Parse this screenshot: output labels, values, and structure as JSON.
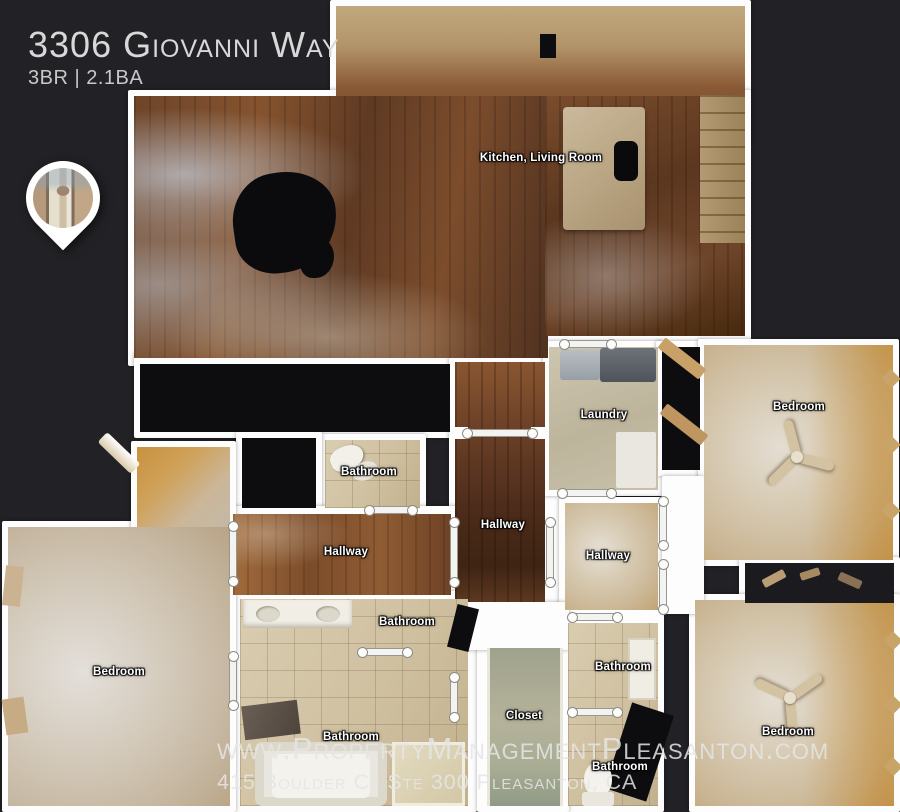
{
  "header": {
    "title": "3306 Giovanni Way",
    "subtitle": "3BR | 2.1BA"
  },
  "watermark": {
    "line1": "www.PropertyManagementPleasanton.com",
    "line2": "415 Boulder Ct Ste 300 Pleasanton, CA"
  },
  "colors": {
    "background": "#222226",
    "wall": "#fdfdfd",
    "label_text": "#ffffff",
    "title_text": "#d8d8d8",
    "watermark_text": "#e5e5e5",
    "wood_floor": "#6e452a",
    "carpet": "#d6c9b1",
    "tile": "#cfc0a0"
  },
  "floorplan": {
    "labels": [
      {
        "name": "label-kitchen-living-room",
        "text": "Kitchen, Living Room",
        "x": 541,
        "y": 158
      },
      {
        "name": "label-laundry",
        "text": "Laundry",
        "x": 604,
        "y": 415
      },
      {
        "name": "label-bedroom-top-right",
        "text": "Bedroom",
        "x": 799,
        "y": 407
      },
      {
        "name": "label-bathroom-top",
        "text": "Bathroom",
        "x": 369,
        "y": 472
      },
      {
        "name": "label-hallway-center",
        "text": "Hallway",
        "x": 503,
        "y": 525
      },
      {
        "name": "label-hallway-left",
        "text": "Hallway",
        "x": 346,
        "y": 552
      },
      {
        "name": "label-hallway-right",
        "text": "Hallway",
        "x": 608,
        "y": 556
      },
      {
        "name": "label-bathroom-toilet-room",
        "text": "Bathroom",
        "x": 407,
        "y": 622
      },
      {
        "name": "label-bathroom-right-upper",
        "text": "Bathroom",
        "x": 623,
        "y": 667
      },
      {
        "name": "label-bedroom-left",
        "text": "Bedroom",
        "x": 119,
        "y": 672
      },
      {
        "name": "label-closet",
        "text": "Closet",
        "x": 524,
        "y": 716
      },
      {
        "name": "label-bathroom-master",
        "text": "Bathroom",
        "x": 351,
        "y": 737
      },
      {
        "name": "label-bedroom-bottom-right",
        "text": "Bedroom",
        "x": 788,
        "y": 732
      },
      {
        "name": "label-bathroom-right-lower",
        "text": "Bathroom",
        "x": 620,
        "y": 767
      }
    ],
    "door_markers": [
      {
        "x": 467,
        "y": 429,
        "w": 66,
        "h": 8
      },
      {
        "x": 546,
        "y": 522,
        "w": 8,
        "h": 61
      },
      {
        "x": 450,
        "y": 522,
        "w": 8,
        "h": 61
      },
      {
        "x": 369,
        "y": 506,
        "w": 44,
        "h": 8
      },
      {
        "x": 229,
        "y": 526,
        "w": 8,
        "h": 56
      },
      {
        "x": 229,
        "y": 656,
        "w": 8,
        "h": 50
      },
      {
        "x": 562,
        "y": 489,
        "w": 50,
        "h": 8
      },
      {
        "x": 659,
        "y": 501,
        "w": 8,
        "h": 45
      },
      {
        "x": 659,
        "y": 564,
        "w": 8,
        "h": 46
      },
      {
        "x": 572,
        "y": 613,
        "w": 46,
        "h": 8
      },
      {
        "x": 572,
        "y": 708,
        "w": 46,
        "h": 8
      },
      {
        "x": 362,
        "y": 648,
        "w": 46,
        "h": 8
      },
      {
        "x": 450,
        "y": 677,
        "w": 8,
        "h": 41
      },
      {
        "x": 564,
        "y": 340,
        "w": 48,
        "h": 8
      }
    ]
  }
}
